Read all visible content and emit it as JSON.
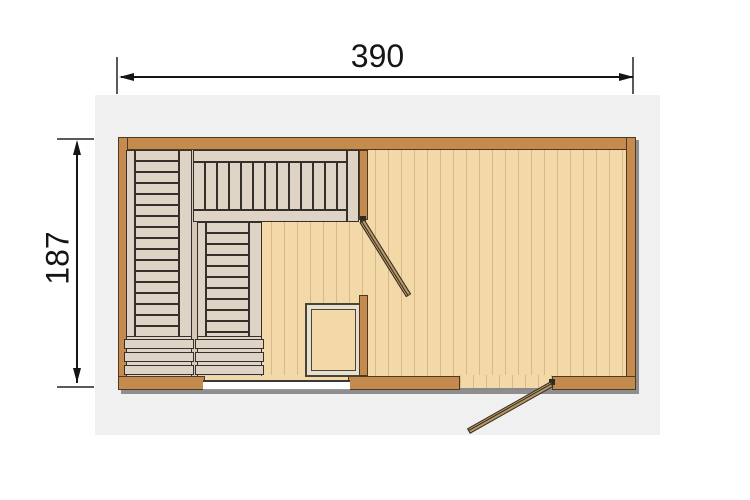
{
  "dimensions": {
    "width_cm": "390",
    "depth_cm": "187"
  },
  "palette": {
    "wall_brown": "#C58A4D",
    "wall_outline": "#4E3A22",
    "floor_tan": "#F3D8A8",
    "floor_plank_line": "#D8B98A",
    "bench_beige": "#DED3C4",
    "bench_outline": "#35312A",
    "door_wood": "#BA9866",
    "glass_white": "#FFFFFF",
    "canvas_gray": "#F0F0F0",
    "shadow_gray": "#8E8E8E",
    "dimension_ink": "#151515"
  }
}
